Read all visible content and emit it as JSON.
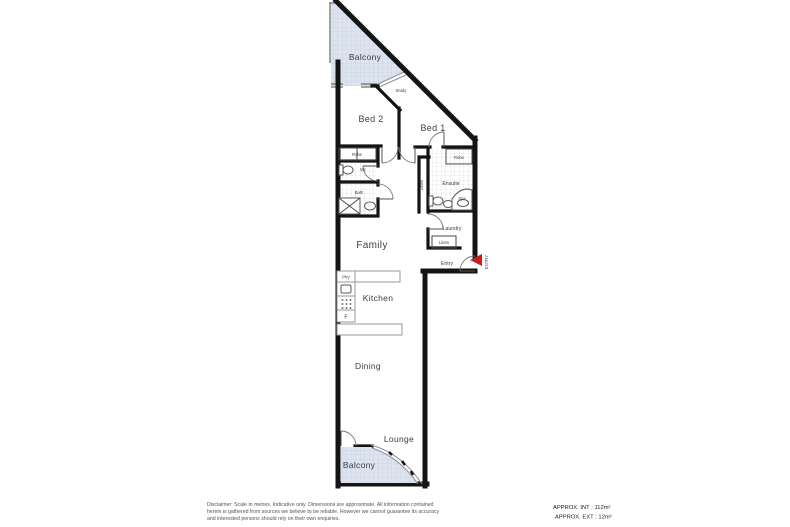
{
  "doc_type": "apartment-floor-plan",
  "colors": {
    "wall": "#141414",
    "balcony_fill": "#dde3ef",
    "balcony_grid": "#c3cbdd",
    "tile_grid": "#d8d8d8",
    "entry_arrow_red": "#c41f1a",
    "label_gray": "#3d3d3d"
  },
  "labels": {
    "balcony_top": "Balcony",
    "study": "Study",
    "bed2": "Bed 2",
    "bed1": "Bed 1",
    "robe_left": "Robe",
    "wc": "Wc",
    "bath": "Bath",
    "linen_hall": "Linen",
    "ensuite": "Ensuite",
    "robe_right": "Robe",
    "spa": "Spa",
    "laundry": "Laundry",
    "linen_entry": "Linen",
    "entry": "Entry",
    "entry_arrow": "ENTRY",
    "family": "Family",
    "pantry": "Ptry",
    "kitchen": "Kitchen",
    "fridge": "F",
    "dining": "Dining",
    "lounge": "Lounge",
    "balcony_bottom": "Balcony"
  },
  "footer": {
    "disclaimer_line1": "Disclaimer: Scale in metres. Indicative only. Dimensions are approximate. All information contained",
    "disclaimer_line2": "herein is gathered from sources we believe to be reliable. However we cannot guarantee its accuracy",
    "disclaimer_line3": "and interested persons should rely on their own enquiries.",
    "approx_int": "APPROX. INT : 112m²",
    "approx_ext": "APPROX. EXT : 12m²"
  }
}
